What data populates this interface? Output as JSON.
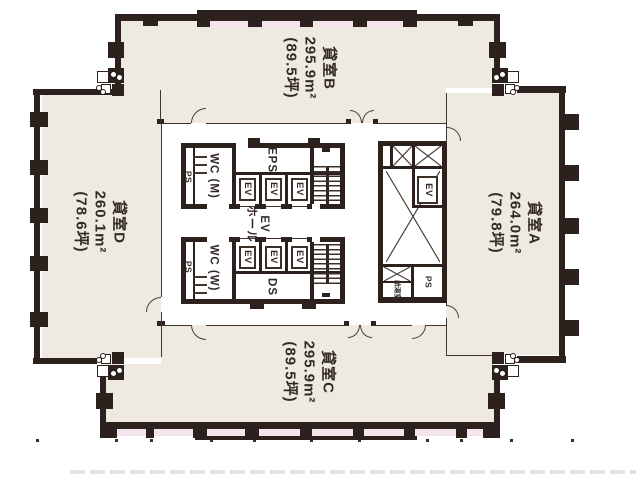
{
  "plan": {
    "rooms": {
      "b": {
        "name": "貸室B",
        "area": "295.9m²",
        "tsubo": "(89.5坪)"
      },
      "a": {
        "name": "貸室A",
        "area": "264.0m²",
        "tsubo": "(79.8坪)"
      },
      "c": {
        "name": "貸室C",
        "area": "295.9m²",
        "tsubo": "(89.5坪)"
      },
      "d": {
        "name": "貸室D",
        "area": "260.1m²",
        "tsubo": "(78.6坪)"
      }
    },
    "core": {
      "wc_m": "WC (M)",
      "wc_w": "WC (W)",
      "ps": "PS",
      "eps": "EPS",
      "ds": "DS",
      "ev": "EV",
      "ev_hall": {
        "line1": "EV",
        "line2": "ホール"
      },
      "kitchenette": "給湯室"
    },
    "colors": {
      "wall": "#2d211e",
      "room_fill": "#efeae1",
      "balcony_pink": "#f4e5ed",
      "text": "#332a27"
    }
  }
}
